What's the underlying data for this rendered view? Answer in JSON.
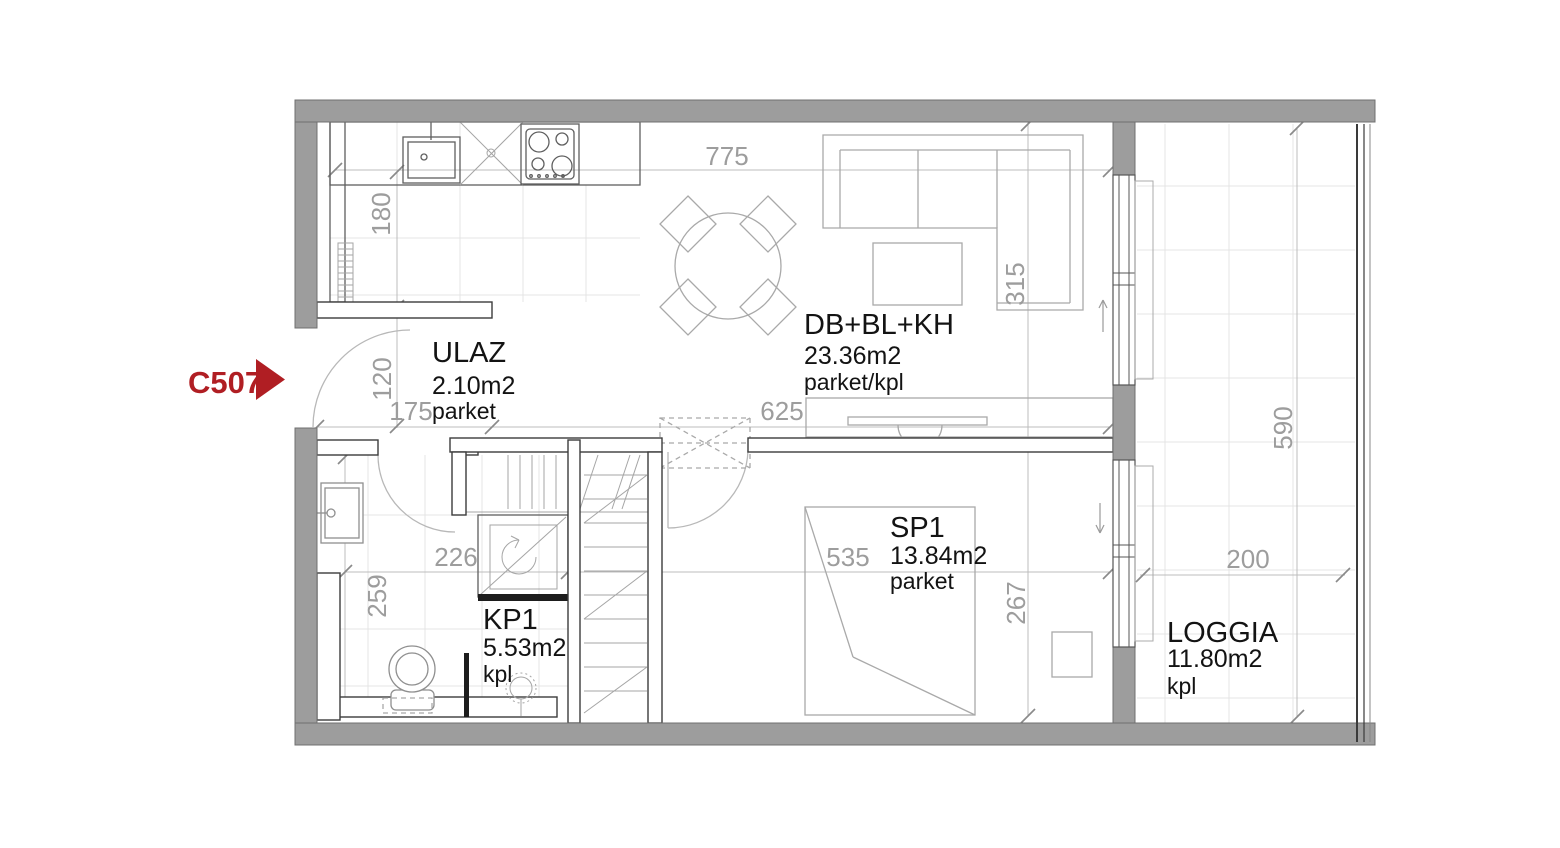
{
  "unit": {
    "label": "C507"
  },
  "rooms": [
    {
      "name": "ULAZ",
      "area": "2.10m2",
      "floor": "parket"
    },
    {
      "name": "DB+BL+KH",
      "area": "23.36m2",
      "floor": "parket/kpl"
    },
    {
      "name": "KP1",
      "area": "5.53m2",
      "floor": "kpl"
    },
    {
      "name": "SP1",
      "area": "13.84m2",
      "floor": "parket"
    },
    {
      "name": "LOGGIA",
      "area": "11.80m2",
      "floor": "kpl"
    }
  ],
  "dimensions": [
    {
      "value": "775"
    },
    {
      "value": "180"
    },
    {
      "value": "120"
    },
    {
      "value": "175"
    },
    {
      "value": "625"
    },
    {
      "value": "315"
    },
    {
      "value": "267"
    },
    {
      "value": "535"
    },
    {
      "value": "226"
    },
    {
      "value": "259"
    },
    {
      "value": "590"
    },
    {
      "value": "200"
    }
  ],
  "colors": {
    "accent_red": "#b01e23",
    "wall_fill": "#9d9d9d",
    "dimension_text": "#9d9d9d",
    "label_text": "#131313"
  }
}
